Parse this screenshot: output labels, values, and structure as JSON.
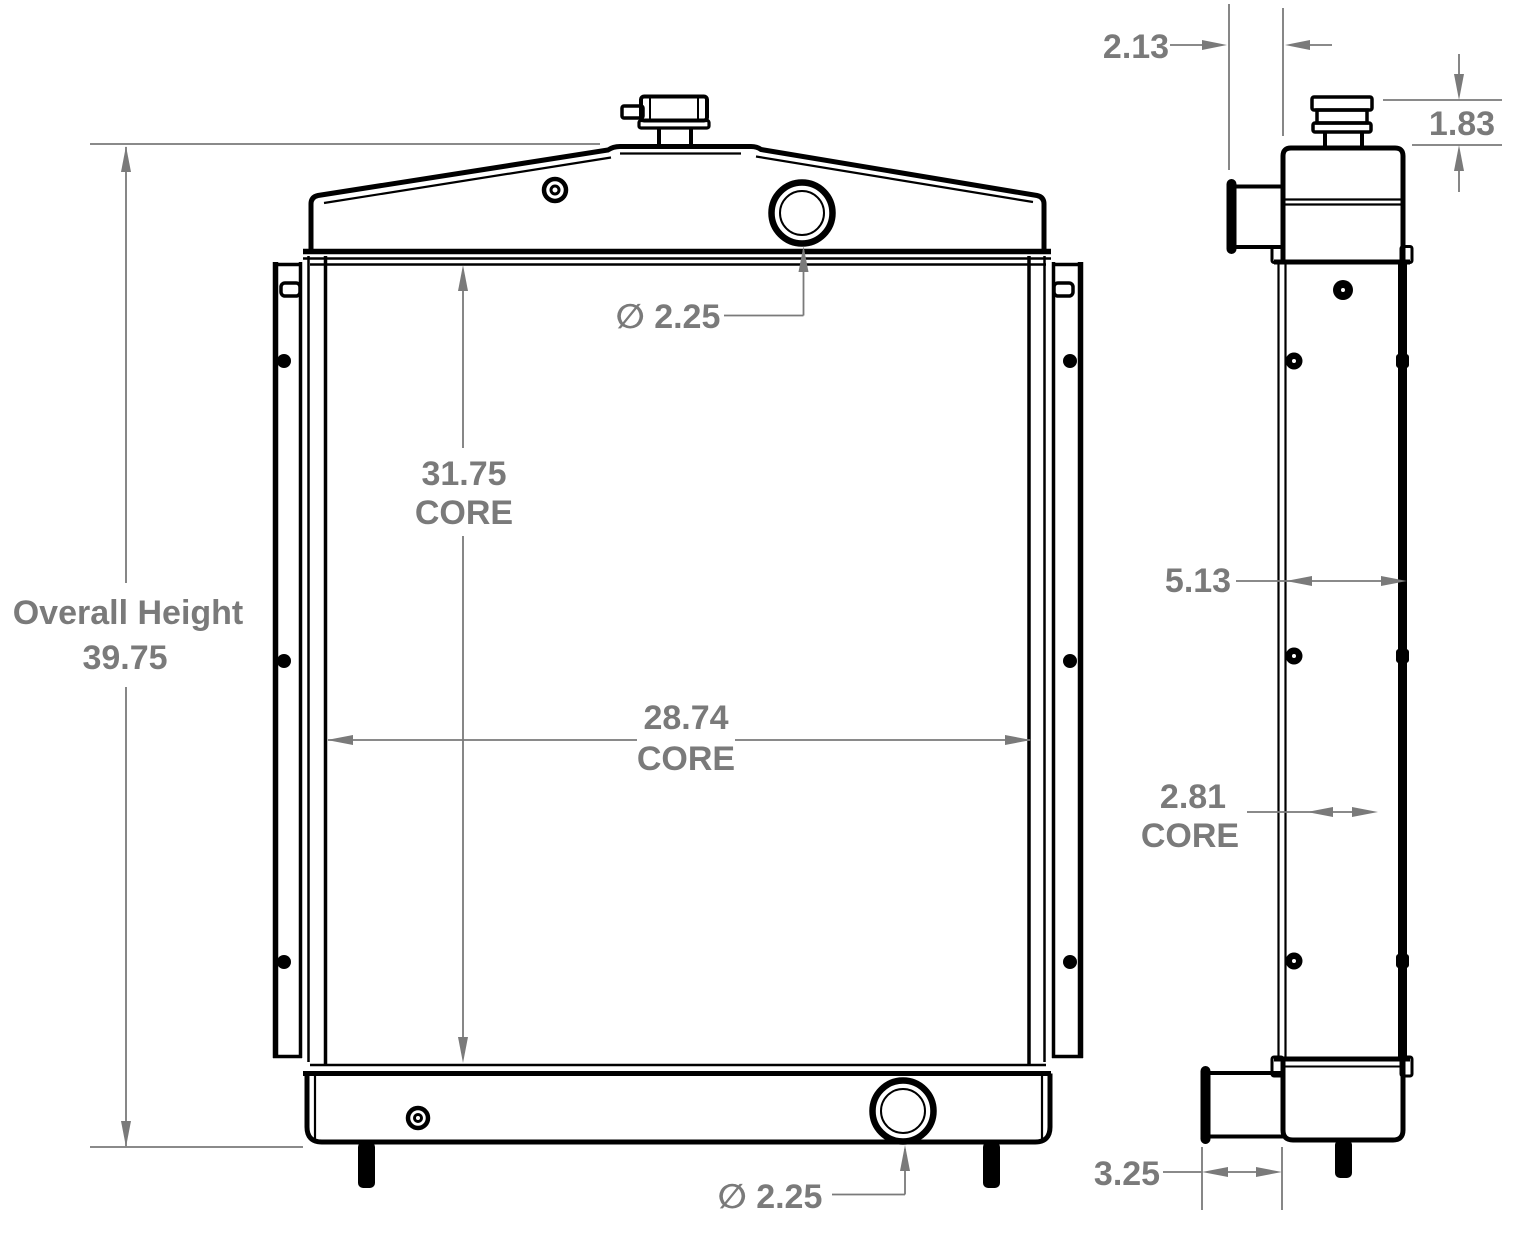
{
  "colors": {
    "line": "#000000",
    "dim": "#7a7a7a",
    "background": "#ffffff"
  },
  "drawing_type": "radiator dimensional drawing, front and side orthographic views",
  "views": {
    "front": {
      "overall_height": {
        "label": "Overall Height",
        "value": "39.75"
      },
      "core_height": {
        "value": "31.75",
        "unit": "CORE"
      },
      "core_width": {
        "value": "28.74",
        "unit": "CORE"
      },
      "top_port": {
        "label": "∅ 2.25"
      },
      "bottom_port": {
        "label": "∅ 2.25"
      }
    },
    "side": {
      "inlet_protrusion": {
        "value": "2.13"
      },
      "cap_height": {
        "value": "1.83"
      },
      "overall_depth": {
        "value": "5.13"
      },
      "core_depth": {
        "value": "2.81",
        "unit": "CORE"
      },
      "outlet_length": {
        "value": "3.25"
      }
    }
  }
}
